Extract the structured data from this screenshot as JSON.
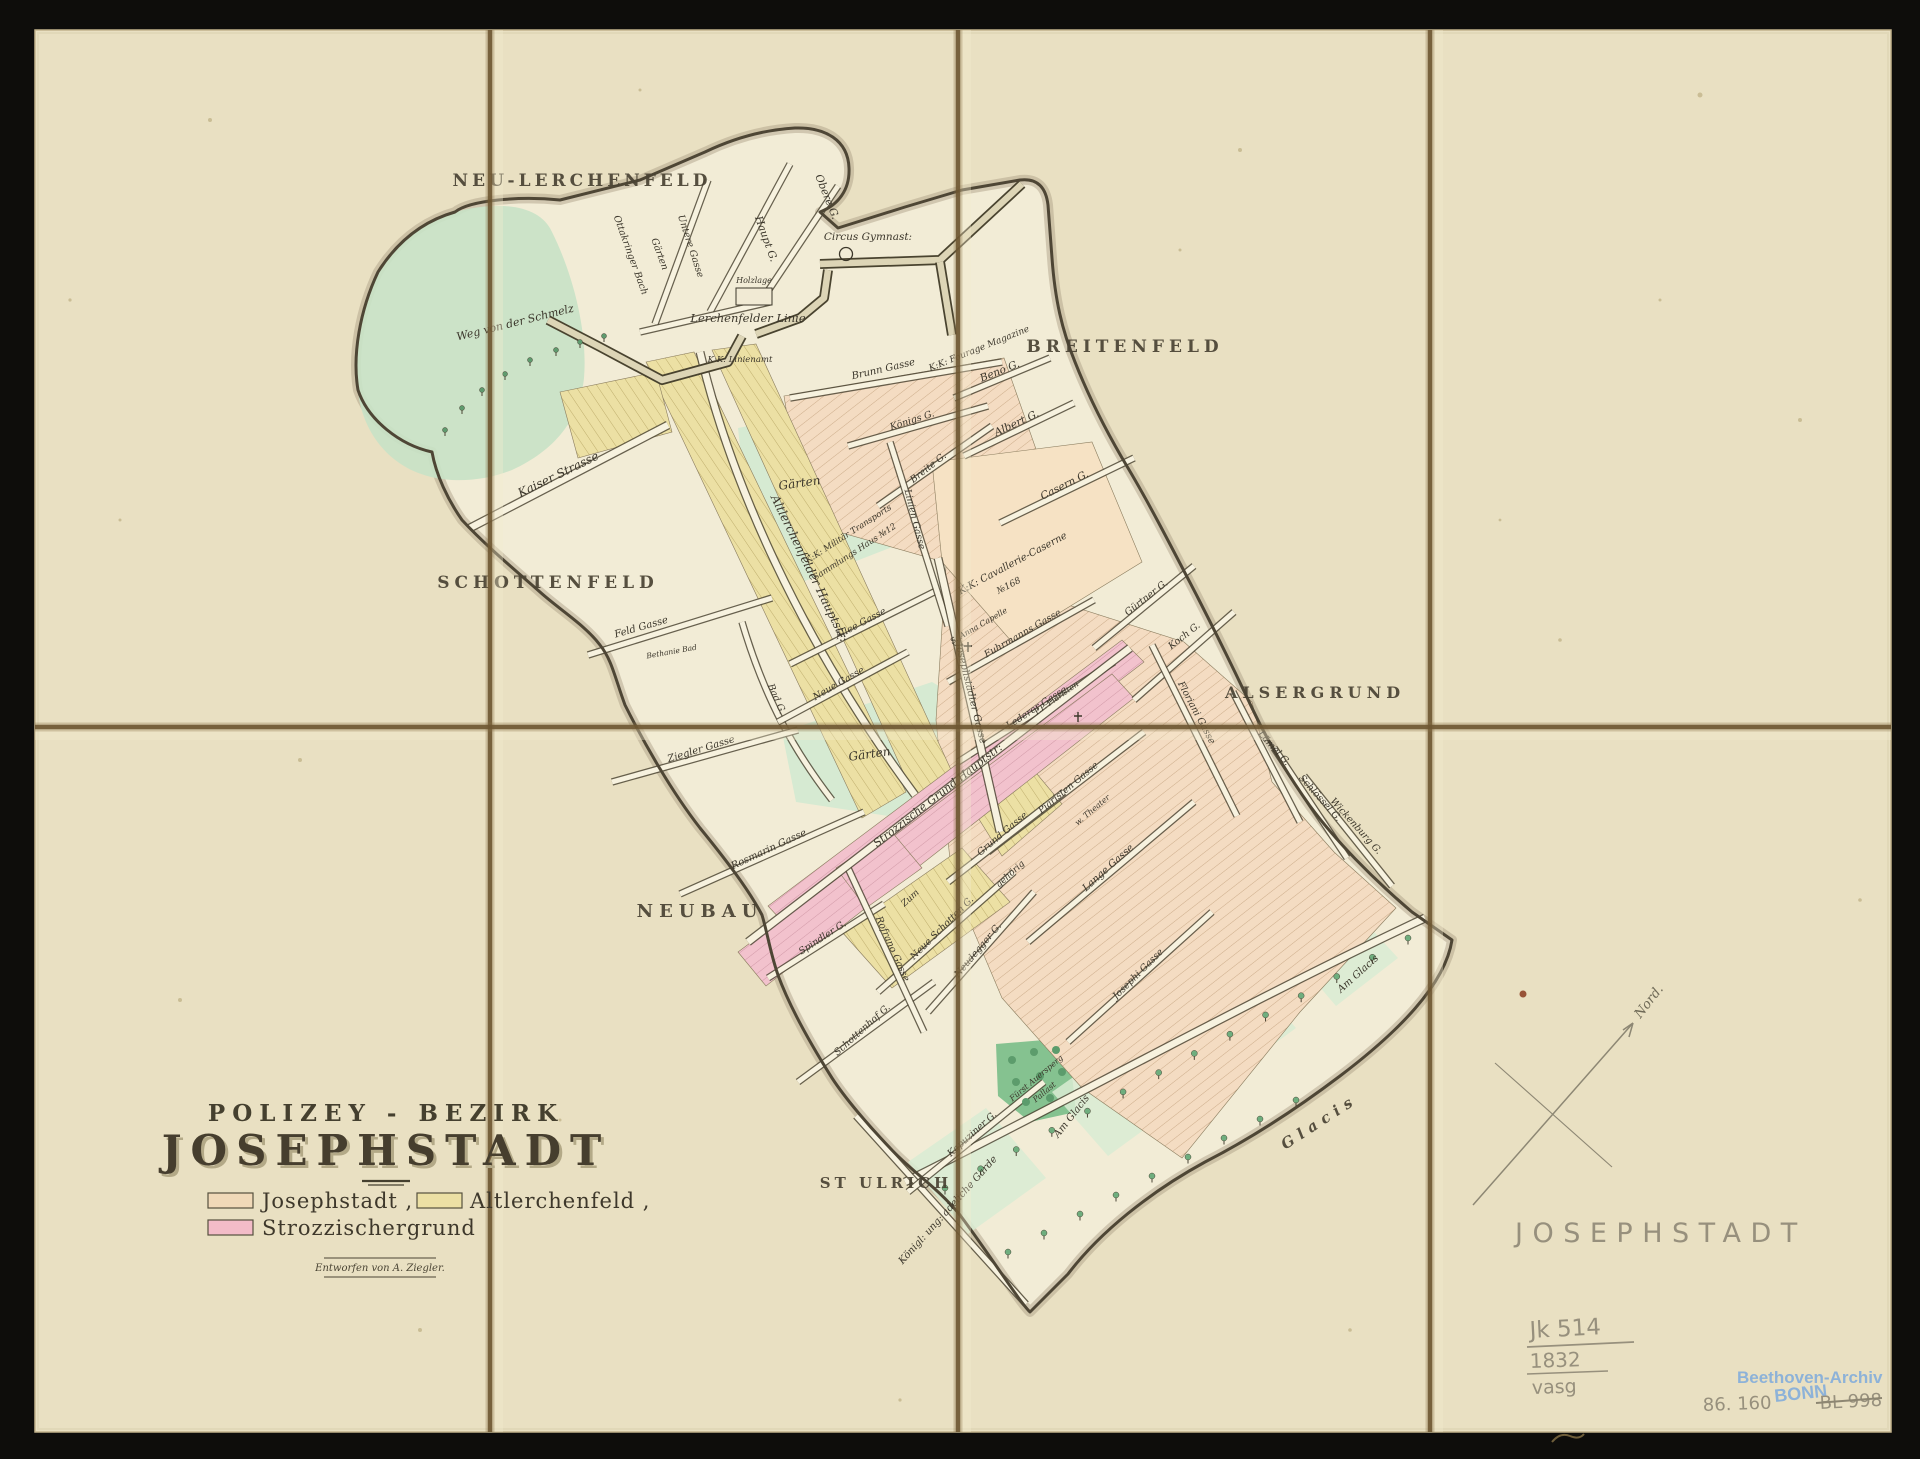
{
  "scan": {
    "mat_color": "#0e0d0b",
    "paper_color": "#e9e0c2",
    "map_ground_color": "#f2ecd6",
    "fold_color": "#6e5732",
    "ink_color": "#3b362b"
  },
  "title_block": {
    "kicker": "POLIZEY - BEZIRK",
    "title": "JOSEPHSTADT",
    "legend": [
      {
        "label": "Josephstadt ,",
        "color": "#f0d9b8"
      },
      {
        "label": "Altlerchenfeld ,",
        "color": "#ece0a4"
      },
      {
        "label": "Strozzischergrund",
        "color": "#f3bcc8"
      }
    ],
    "credit": "Entworfen von A. Ziegler."
  },
  "map": {
    "district_labels": [
      {
        "t": "NEU-LERCHENFELD",
        "x": 582,
        "y": 186,
        "r": 0,
        "s": 17,
        "ls": 4
      },
      {
        "t": "BREITENFELD",
        "x": 1125,
        "y": 352,
        "r": 0,
        "s": 17,
        "ls": 5
      },
      {
        "t": "SCHOTTENFELD",
        "x": 548,
        "y": 588,
        "r": 0,
        "s": 17,
        "ls": 5
      },
      {
        "t": "ALSERGRUND",
        "x": 1315,
        "y": 698,
        "r": 0,
        "s": 16,
        "ls": 5
      },
      {
        "t": "NEUBAU",
        "x": 700,
        "y": 917,
        "r": 0,
        "s": 18,
        "ls": 6
      },
      {
        "t": "ST ULRICH",
        "x": 886,
        "y": 1188,
        "r": 0,
        "s": 15,
        "ls": 4
      },
      {
        "t": "Glacis",
        "x": 1322,
        "y": 1126,
        "r": -33,
        "s": 15,
        "ls": 6,
        "i": 1
      }
    ],
    "street_labels": [
      {
        "t": "Obere G.",
        "x": 824,
        "y": 198,
        "r": 68
      },
      {
        "t": "Haupt G.",
        "x": 763,
        "y": 240,
        "r": 70
      },
      {
        "t": "Untere Gasse",
        "x": 688,
        "y": 247,
        "r": 72,
        "s": 9.5
      },
      {
        "t": "Gärten",
        "x": 657,
        "y": 255,
        "r": 70,
        "s": 9.5
      },
      {
        "t": "Ottakringer Bach",
        "x": 628,
        "y": 256,
        "r": 70,
        "s": 9.5
      },
      {
        "t": "Weg von der Schmelz",
        "x": 516,
        "y": 326,
        "r": -14,
        "s": 11
      },
      {
        "t": "Circus Gymnast:",
        "x": 868,
        "y": 240,
        "r": 0,
        "s": 10.5
      },
      {
        "t": "Holzlage",
        "x": 754,
        "y": 283,
        "r": 0,
        "s": 8
      },
      {
        "t": "Lerchenfelder Linie",
        "x": 748,
        "y": 322,
        "r": 0,
        "s": 11.5
      },
      {
        "t": "K:K: Linienamt",
        "x": 740,
        "y": 362,
        "r": 0,
        "s": 8.5
      },
      {
        "t": "Brunn Gasse",
        "x": 884,
        "y": 372,
        "r": -13,
        "s": 10
      },
      {
        "t": "K:K: Fourage Magazine",
        "x": 980,
        "y": 351,
        "r": -22,
        "s": 9
      },
      {
        "t": "Beno G.",
        "x": 1001,
        "y": 374,
        "r": -22
      },
      {
        "t": "Albert G.",
        "x": 1018,
        "y": 426,
        "r": -25
      },
      {
        "t": "Casern G.",
        "x": 1066,
        "y": 488,
        "r": -27
      },
      {
        "t": "Königs G.",
        "x": 913,
        "y": 423,
        "r": -18,
        "s": 9.5
      },
      {
        "t": "Breite G.",
        "x": 930,
        "y": 470,
        "r": -38,
        "s": 9.5
      },
      {
        "t": "Linien Gasse",
        "x": 912,
        "y": 520,
        "r": 76,
        "s": 9.5
      },
      {
        "t": "Kaiser Strasse",
        "x": 560,
        "y": 478,
        "r": -26,
        "s": 12
      },
      {
        "t": "Altlerchenfelder Hauptstr:",
        "x": 806,
        "y": 570,
        "r": 64,
        "s": 12
      },
      {
        "t": "Bad G.",
        "x": 774,
        "y": 700,
        "r": 66,
        "s": 9.5
      },
      {
        "t": "Feld Gasse",
        "x": 642,
        "y": 630,
        "r": -16,
        "s": 10
      },
      {
        "t": "Bethanie Bad",
        "x": 672,
        "y": 654,
        "r": -10,
        "s": 7.5
      },
      {
        "t": "Gärten",
        "x": 800,
        "y": 487,
        "r": -8,
        "s": 12
      },
      {
        "t": "K:K: Militär Transports",
        "x": 850,
        "y": 536,
        "r": -33,
        "s": 8.5
      },
      {
        "t": "Sammlungs Haus №12",
        "x": 856,
        "y": 554,
        "r": -33,
        "s": 8.5
      },
      {
        "t": "K:K: Cavallerie-Caserne",
        "x": 1014,
        "y": 566,
        "r": -28,
        "s": 10
      },
      {
        "t": "№168",
        "x": 1010,
        "y": 588,
        "r": -28,
        "s": 9
      },
      {
        "t": "Gürtner G.",
        "x": 1148,
        "y": 600,
        "r": -38,
        "s": 9.5
      },
      {
        "t": "Koch G.",
        "x": 1186,
        "y": 638,
        "r": -38,
        "s": 9.5
      },
      {
        "t": "Floriani Gasse",
        "x": 1194,
        "y": 714,
        "r": 62,
        "s": 9.5
      },
      {
        "t": "Lämel G.",
        "x": 1272,
        "y": 750,
        "r": 48,
        "s": 9.5
      },
      {
        "t": "Schlössel G.",
        "x": 1318,
        "y": 800,
        "r": 48,
        "s": 9.5
      },
      {
        "t": "Wickenburg G.",
        "x": 1354,
        "y": 828,
        "r": 48,
        "s": 9.5
      },
      {
        "t": "Fuhrmanns Gasse",
        "x": 1024,
        "y": 636,
        "r": -30,
        "s": 9.5
      },
      {
        "t": "S. Anna Capelle",
        "x": 980,
        "y": 628,
        "r": -30,
        "s": 8
      },
      {
        "t": "Lederer Gasse",
        "x": 1038,
        "y": 710,
        "r": -33,
        "s": 9.5
      },
      {
        "t": "P.P. Piaristen",
        "x": 1058,
        "y": 700,
        "r": -35,
        "s": 8
      },
      {
        "t": "Piaristen Gasse",
        "x": 1070,
        "y": 790,
        "r": -40,
        "s": 9.5
      },
      {
        "t": "Lange Gasse",
        "x": 1110,
        "y": 870,
        "r": -42,
        "s": 10
      },
      {
        "t": "Grund Gasse",
        "x": 1004,
        "y": 836,
        "r": -40,
        "s": 9.5
      },
      {
        "t": "w. Theater",
        "x": 1094,
        "y": 812,
        "r": -40,
        "s": 8
      },
      {
        "t": "Josephi Gasse",
        "x": 1140,
        "y": 976,
        "r": -45,
        "s": 9.5
      },
      {
        "t": "Neue Schotten G.",
        "x": 944,
        "y": 930,
        "r": -45,
        "s": 9.5
      },
      {
        "t": "Zum",
        "x": 912,
        "y": 900,
        "r": -42,
        "s": 9
      },
      {
        "t": "gehörig",
        "x": 1012,
        "y": 876,
        "r": -42,
        "s": 9
      },
      {
        "t": "Neudegger G.",
        "x": 980,
        "y": 952,
        "r": -50,
        "s": 9.5
      },
      {
        "t": "Schottenhof G.",
        "x": 864,
        "y": 1032,
        "r": -42,
        "s": 9.5
      },
      {
        "t": "Spindler G.",
        "x": 824,
        "y": 940,
        "r": -33,
        "s": 9.5
      },
      {
        "t": "Rofrano Gasse",
        "x": 890,
        "y": 950,
        "r": 66,
        "s": 9.5
      },
      {
        "t": "Ziegler Gasse",
        "x": 702,
        "y": 752,
        "r": -17,
        "s": 10
      },
      {
        "t": "Rosmarin Gasse",
        "x": 770,
        "y": 852,
        "r": -25,
        "s": 10
      },
      {
        "t": "Neue Gasse",
        "x": 840,
        "y": 686,
        "r": -30,
        "s": 9.5
      },
      {
        "t": "Allee Gasse",
        "x": 862,
        "y": 626,
        "r": -28,
        "s": 9.5
      },
      {
        "t": "Josephstädter Gasse",
        "x": 968,
        "y": 694,
        "r": 76,
        "s": 10
      },
      {
        "t": "Strozzische Grund Hauptstr:",
        "x": 940,
        "y": 798,
        "r": -38,
        "s": 11
      },
      {
        "t": "Kapuziner G.",
        "x": 974,
        "y": 1136,
        "r": -42,
        "s": 9.5
      },
      {
        "t": "Königl: ung: adeliche Garde",
        "x": 950,
        "y": 1212,
        "r": -48,
        "s": 10
      },
      {
        "t": "Fürst Auersperg",
        "x": 1038,
        "y": 1080,
        "r": -40,
        "s": 8
      },
      {
        "t": "Pallast",
        "x": 1046,
        "y": 1094,
        "r": -40,
        "s": 8
      },
      {
        "t": "Am Glacis",
        "x": 1074,
        "y": 1118,
        "r": -52,
        "s": 10
      },
      {
        "t": "Am Glacis",
        "x": 1360,
        "y": 976,
        "r": -42,
        "s": 10
      },
      {
        "t": "Gärten",
        "x": 870,
        "y": 758,
        "r": -8,
        "s": 12
      }
    ],
    "compass_label": {
      "t": "Nord.",
      "x": 1652,
      "y": 1004,
      "r": -52,
      "s": 13,
      "k": "pscript"
    }
  },
  "annotations": {
    "pencil_title": "JOSEPHSTADT",
    "catalog_no": "Jk 514",
    "year": "1832",
    "initials": "vasg",
    "stamp_line1": "Beethoven-Archiv",
    "stamp_line2": "BONN",
    "accession_no": "86. 160",
    "crossed_out_no": "BL 998"
  }
}
